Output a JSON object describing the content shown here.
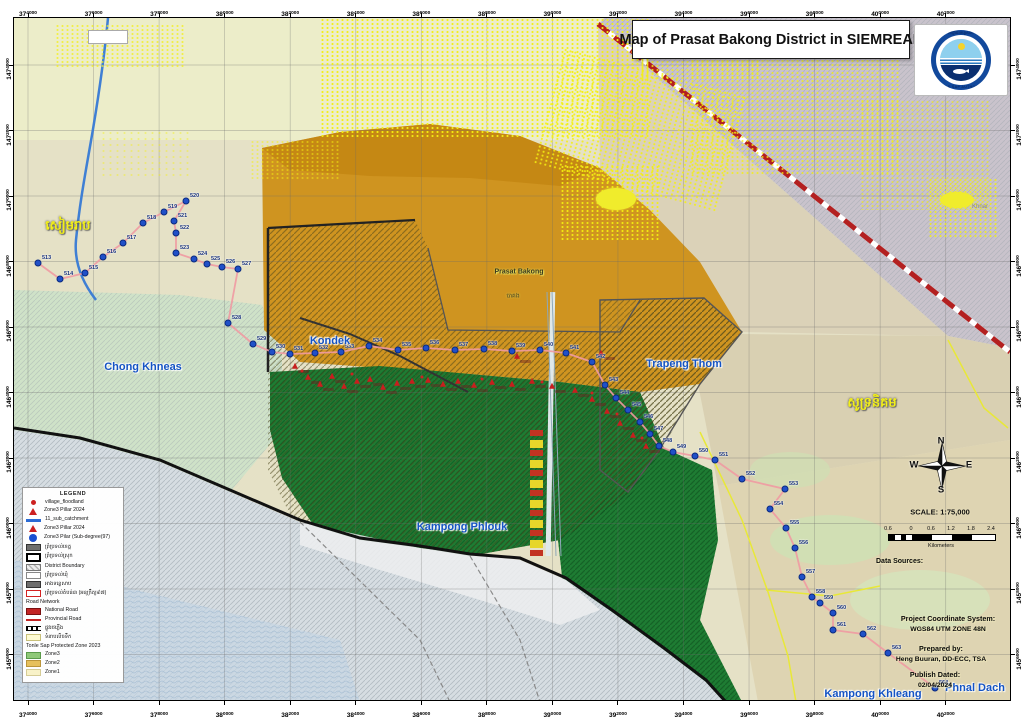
{
  "page_title": "Map of Prasat Bakong District in SIEMREAP",
  "logo": {
    "khmer_text": "អាជ្ញាធរទន្លេសាប",
    "english_text": "TONLE SAP AUTHORITY"
  },
  "frame": {
    "eastings": [
      "374000",
      "376000",
      "378000",
      "380000",
      "382000",
      "384000",
      "386000",
      "388000",
      "390000",
      "392000",
      "394000",
      "396000",
      "398000",
      "400000",
      "402000"
    ],
    "northings": [
      "1474000",
      "1472000",
      "1470000",
      "1468000",
      "1466000",
      "1464000",
      "1462000",
      "1460000",
      "1458000",
      "1456000"
    ]
  },
  "compass": {
    "n": "N",
    "e": "E",
    "s": "S",
    "w": "W"
  },
  "scale": {
    "text": "SCALE: 1:75,000",
    "bar_labels": [
      "0.6",
      "0",
      "0.6",
      "1.2",
      "1.8",
      "2.4"
    ],
    "unit": "Kilometers"
  },
  "data_sources": {
    "heading": "Data Sources:",
    "items": [
      "- Zone3 Pillar, Sub-degree 197, 2011",
      "- Zone3 Pillar, 2024",
      "- Fishery Community, 2023",
      "- Administration Boundary, MLMUC 2022",
      "- National Road, MPWT, 2023"
    ]
  },
  "projection": {
    "heading": "Project Coordinate System:",
    "value": "WGS84 UTM ZONE 48N"
  },
  "prepared": {
    "heading": "Prepared by:",
    "value": "Heng Buuran, DD-ECC, TSA"
  },
  "published": {
    "heading": "Publish Dated:",
    "value": "02/04/2024"
  },
  "legend": {
    "heading": "LEGEND",
    "items": [
      {
        "swatch": "dot-red",
        "label": "village_floodland"
      },
      {
        "swatch": "tri-red",
        "label": "Zone3 Pillar 2024"
      },
      {
        "swatch": "line-blue",
        "label": "11_sub_catchment"
      },
      {
        "swatch": "tri-red",
        "label": "Zone3 Pillar 2024"
      },
      {
        "swatch": "dot-blue",
        "label": "Zone3 Pilar (Sub-degree(97)"
      },
      {
        "swatch": "box-darkgray",
        "label": "ព្រំប្រទល់ខេត្ត"
      },
      {
        "swatch": "box-blackline",
        "label": "ព្រំប្រទល់ស្រុក"
      },
      {
        "swatch": "box-grayhatch",
        "label": "District Boundary"
      },
      {
        "swatch": "box-white",
        "label": "ព្រំប្រទល់ឃុំ"
      },
      {
        "swatch": "box-darkgray",
        "label": "អាងទន្លេសាប"
      },
      {
        "swatch": "box-redline",
        "label": "ព្រំប្រទល់តំបន់៣ (អនុក្រឹត្យ៩៧)"
      },
      {
        "header": "Road Network"
      },
      {
        "swatch": "box-red",
        "label": "National Road"
      },
      {
        "swatch": "line-red",
        "label": "Provincial Road"
      },
      {
        "swatch": "line-xhatch",
        "label": "ផ្លូវរថភ្លើង"
      },
      {
        "swatch": "box-paleyellow",
        "label": "ទំនាបលិចទឹក"
      },
      {
        "header": "Tonle Sap Protected Zone 2023"
      },
      {
        "swatch": "box-green",
        "label": "Zone3"
      },
      {
        "swatch": "box-orange",
        "label": "Zone2"
      },
      {
        "swatch": "box-lightyellow",
        "label": "Zone1"
      }
    ]
  },
  "place_labels": [
    {
      "text": "សៀមរាប",
      "x": 68,
      "y": 227,
      "cls": "khmer-yellow"
    },
    {
      "text": "សូទ្រនិគម",
      "x": 872,
      "y": 404,
      "cls": "khmer-yellow"
    },
    {
      "text": "Chong Khneas",
      "x": 143,
      "y": 367,
      "cls": "commune"
    },
    {
      "text": "Kondek",
      "x": 330,
      "y": 341,
      "cls": "commune"
    },
    {
      "text": "Trapeng Thom",
      "x": 684,
      "y": 364,
      "cls": "commune"
    },
    {
      "text": "Kampong Phlouk",
      "x": 462,
      "y": 527,
      "cls": "commune"
    },
    {
      "text": "Kampong Khleang",
      "x": 873,
      "y": 694,
      "cls": "commune"
    },
    {
      "text": "Phnal Dach",
      "x": 975,
      "y": 688,
      "cls": "commune"
    },
    {
      "text": "Prasat Bakong",
      "x": 519,
      "y": 272,
      "cls": "site-label"
    },
    {
      "text": "បាគង",
      "x": 513,
      "y": 296,
      "cls": "site-khmer"
    },
    {
      "text": "Khnar",
      "x": 980,
      "y": 207,
      "cls": "faint"
    }
  ],
  "pillars": {
    "dots": [
      {
        "n": "513",
        "x": 38,
        "y": 263
      },
      {
        "n": "514",
        "x": 60,
        "y": 279
      },
      {
        "n": "515",
        "x": 85,
        "y": 273
      },
      {
        "n": "516",
        "x": 103,
        "y": 257
      },
      {
        "n": "517",
        "x": 123,
        "y": 243
      },
      {
        "n": "518",
        "x": 143,
        "y": 223
      },
      {
        "n": "519",
        "x": 164,
        "y": 212
      },
      {
        "n": "520",
        "x": 186,
        "y": 201
      },
      {
        "n": "521",
        "x": 174,
        "y": 221
      },
      {
        "n": "522",
        "x": 176,
        "y": 233
      },
      {
        "n": "523",
        "x": 176,
        "y": 253
      },
      {
        "n": "524",
        "x": 194,
        "y": 259
      },
      {
        "n": "525",
        "x": 207,
        "y": 264
      },
      {
        "n": "526",
        "x": 222,
        "y": 267
      },
      {
        "n": "527",
        "x": 238,
        "y": 269
      },
      {
        "n": "528",
        "x": 228,
        "y": 323
      },
      {
        "n": "529",
        "x": 253,
        "y": 344
      },
      {
        "n": "530",
        "x": 272,
        "y": 352
      },
      {
        "n": "531",
        "x": 290,
        "y": 354
      },
      {
        "n": "532",
        "x": 315,
        "y": 353
      },
      {
        "n": "533",
        "x": 341,
        "y": 352
      },
      {
        "n": "534",
        "x": 369,
        "y": 346
      },
      {
        "n": "535",
        "x": 398,
        "y": 350
      },
      {
        "n": "536",
        "x": 426,
        "y": 348
      },
      {
        "n": "537",
        "x": 455,
        "y": 350
      },
      {
        "n": "538",
        "x": 484,
        "y": 349
      },
      {
        "n": "539",
        "x": 512,
        "y": 351
      },
      {
        "n": "540",
        "x": 540,
        "y": 350
      },
      {
        "n": "541",
        "x": 566,
        "y": 353
      },
      {
        "n": "542",
        "x": 592,
        "y": 362
      },
      {
        "n": "543",
        "x": 605,
        "y": 385
      },
      {
        "n": "544",
        "x": 616,
        "y": 398
      },
      {
        "n": "545",
        "x": 628,
        "y": 410
      },
      {
        "n": "546",
        "x": 640,
        "y": 422
      },
      {
        "n": "547",
        "x": 650,
        "y": 434
      },
      {
        "n": "548",
        "x": 659,
        "y": 446
      },
      {
        "n": "549",
        "x": 673,
        "y": 452
      },
      {
        "n": "550",
        "x": 695,
        "y": 456
      },
      {
        "n": "551",
        "x": 715,
        "y": 460
      },
      {
        "n": "552",
        "x": 742,
        "y": 479
      },
      {
        "n": "553",
        "x": 785,
        "y": 489
      },
      {
        "n": "554",
        "x": 770,
        "y": 509
      },
      {
        "n": "555",
        "x": 786,
        "y": 528
      },
      {
        "n": "556",
        "x": 795,
        "y": 548
      },
      {
        "n": "557",
        "x": 802,
        "y": 577
      },
      {
        "n": "558",
        "x": 812,
        "y": 597
      },
      {
        "n": "559",
        "x": 820,
        "y": 603
      },
      {
        "n": "560",
        "x": 833,
        "y": 613
      },
      {
        "n": "561",
        "x": 833,
        "y": 630
      },
      {
        "n": "562",
        "x": 863,
        "y": 634
      },
      {
        "n": "563",
        "x": 888,
        "y": 653
      },
      {
        "n": "564",
        "x": 935,
        "y": 688
      }
    ],
    "triangles": [
      [
        295,
        366
      ],
      [
        308,
        377
      ],
      [
        320,
        384
      ],
      [
        332,
        376
      ],
      [
        344,
        386
      ],
      [
        357,
        381
      ],
      [
        370,
        379
      ],
      [
        383,
        387
      ],
      [
        397,
        383
      ],
      [
        412,
        381
      ],
      [
        428,
        380
      ],
      [
        443,
        384
      ],
      [
        458,
        381
      ],
      [
        474,
        385
      ],
      [
        492,
        382
      ],
      [
        512,
        384
      ],
      [
        532,
        381
      ],
      [
        552,
        386
      ],
      [
        575,
        390
      ],
      [
        592,
        399
      ],
      [
        607,
        411
      ],
      [
        620,
        423
      ],
      [
        633,
        435
      ],
      [
        646,
        446
      ],
      [
        517,
        356
      ],
      [
        601,
        353
      ]
    ],
    "villages": [
      [
        302,
        371
      ],
      [
        352,
        374
      ],
      [
        422,
        377
      ],
      [
        482,
        379
      ],
      [
        542,
        382
      ],
      [
        592,
        393
      ],
      [
        617,
        414
      ],
      [
        642,
        438
      ]
    ]
  },
  "colors": {
    "zone3_green": "#1e7c33",
    "zone2_amber": "#cf9420",
    "city_gray": "#c9c3cc",
    "lake": "#d6dde2",
    "national_road": "#b32020",
    "pillar_line": "#ef9aa2",
    "label_blue": "#1453c4",
    "khmer_yellow": "#f2ef1a"
  }
}
